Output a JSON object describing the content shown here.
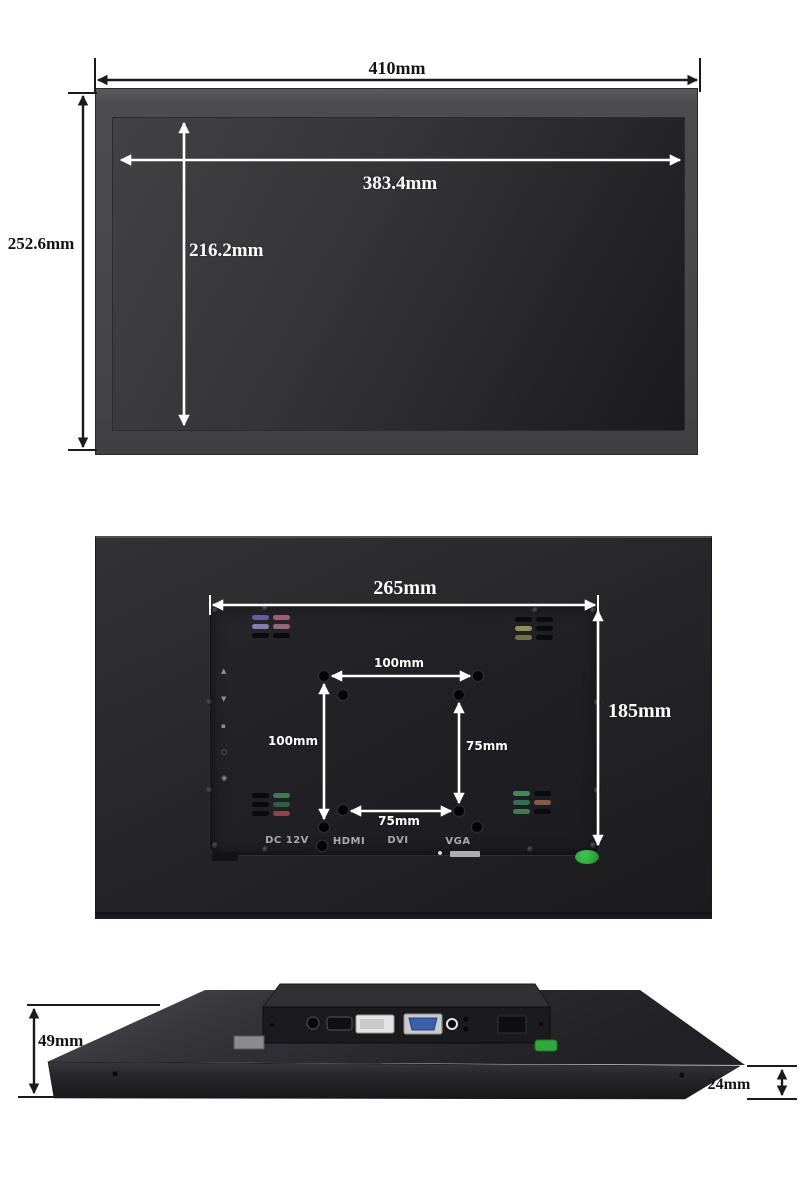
{
  "front_view": {
    "overall_width": "410mm",
    "overall_height": "252.6mm",
    "display_width": "383.4mm",
    "display_height": "216.2mm"
  },
  "back_view": {
    "mount_plate_width": "265mm",
    "mount_plate_height": "185mm",
    "vesa_100_width": "100mm",
    "vesa_100_height": "100mm",
    "vesa_75_height": "75mm",
    "vesa_75_width": "75mm",
    "port_labels": [
      "DC 12V",
      "HDMI",
      "DVI",
      "VGA"
    ],
    "osd_buttons": [
      "▲",
      "▼",
      "▪",
      "○",
      "◉"
    ]
  },
  "side_view": {
    "total_depth": "49mm",
    "edge_thickness": "24mm"
  },
  "colors": {
    "bezel_gray": "#4a4a4d",
    "back_panel_dark": "#232326",
    "screen_dark": "#202023",
    "dimension_line_black": "#1a1a1a",
    "dimension_arrow_white": "#ffffff",
    "power_led_green": "#2fa83c",
    "vga_port_blue": "#3a5fa8",
    "dvi_port_light": "#e4e4e2"
  }
}
